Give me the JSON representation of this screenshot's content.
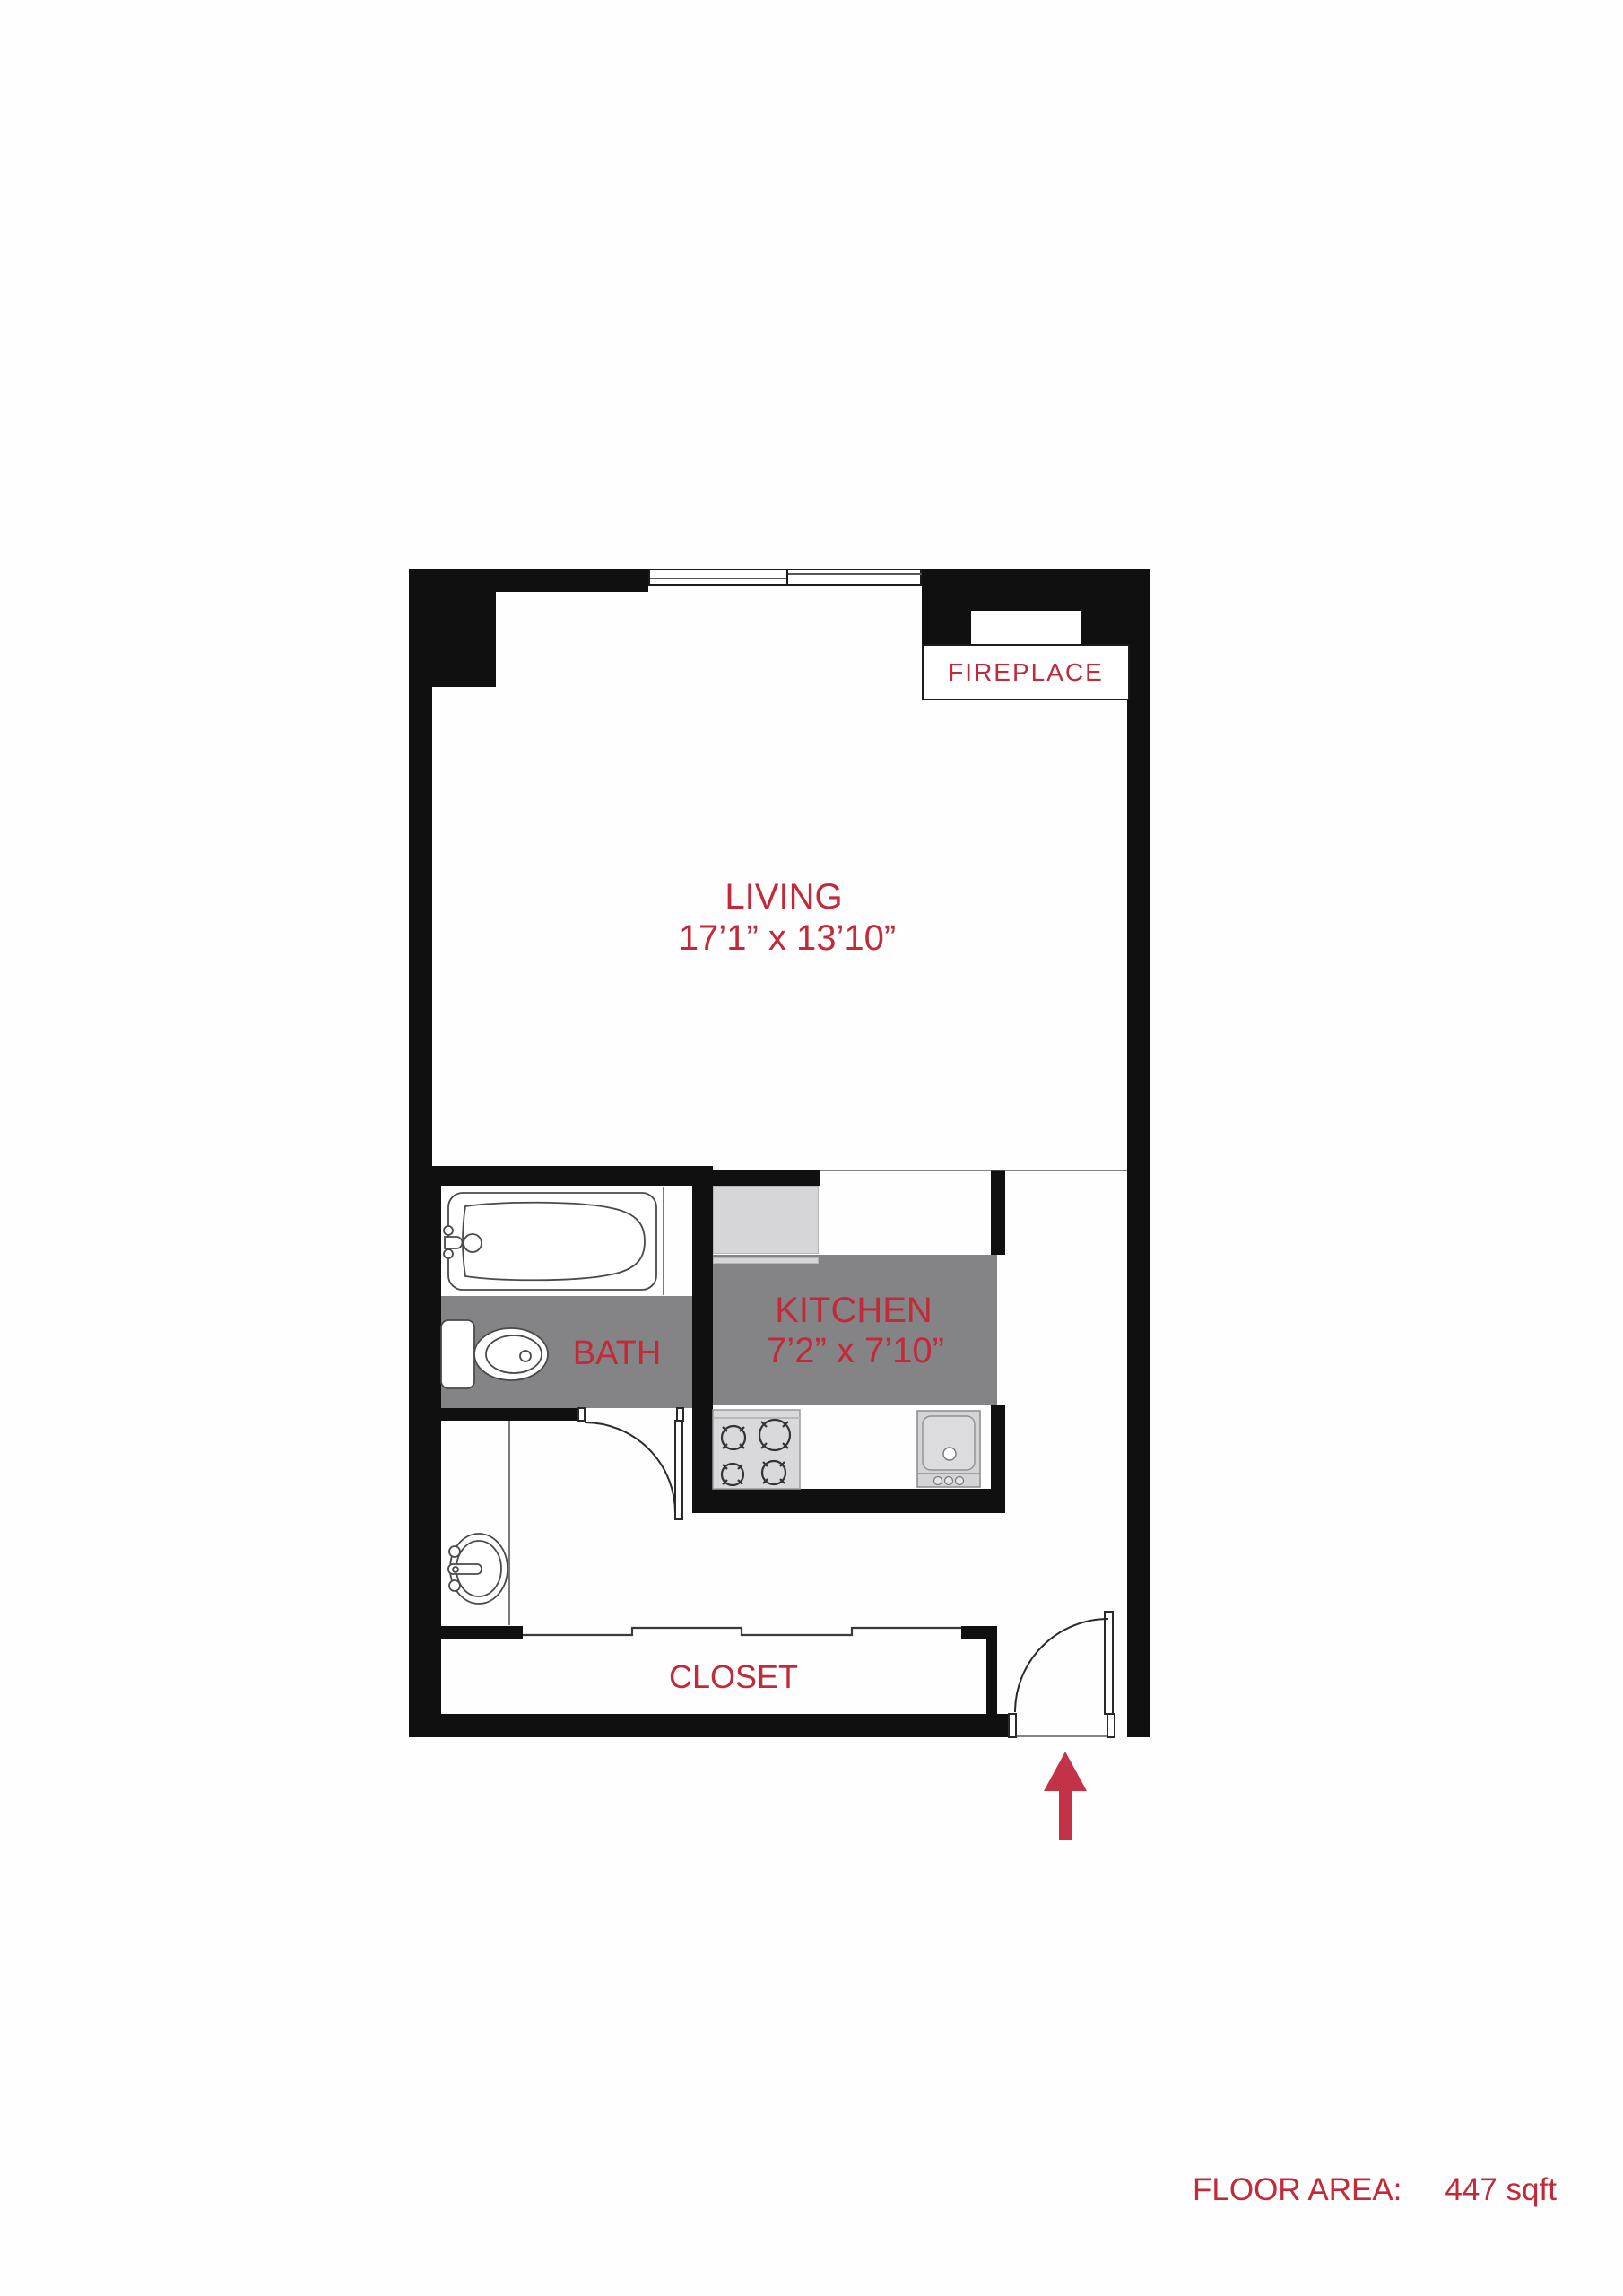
{
  "colors": {
    "wall": "#101010",
    "accent": "#c22a39",
    "arrow": "#c43247",
    "floor_gray": "#848487",
    "appliance": "#d6d6d8",
    "paper": "#fefefe"
  },
  "rooms": {
    "fireplace": {
      "label": "FIREPLACE"
    },
    "living": {
      "label": "LIVING",
      "dimensions": "17’1” x 13’10”"
    },
    "kitchen": {
      "label": "KITCHEN",
      "dimensions": "7’2” x 7’10”"
    },
    "bath": {
      "label": "BATH"
    },
    "closet": {
      "label": "CLOSET"
    }
  },
  "footer": {
    "floor_area_label": "FLOOR AREA:",
    "floor_area_value": "447 sqft"
  },
  "icons": {
    "bathtub": "bathtub-icon",
    "toilet": "toilet-icon",
    "vanity_sink": "vanity-sink-icon",
    "stove": "stove-icon",
    "kitchen_sink": "kitchen-sink-icon",
    "bath_door": "door-swing-icon",
    "entry_door": "door-swing-icon",
    "closet_doors": "sliding-door-icon",
    "window": "window-icon",
    "entry_arrow": "entry-arrow-icon"
  }
}
